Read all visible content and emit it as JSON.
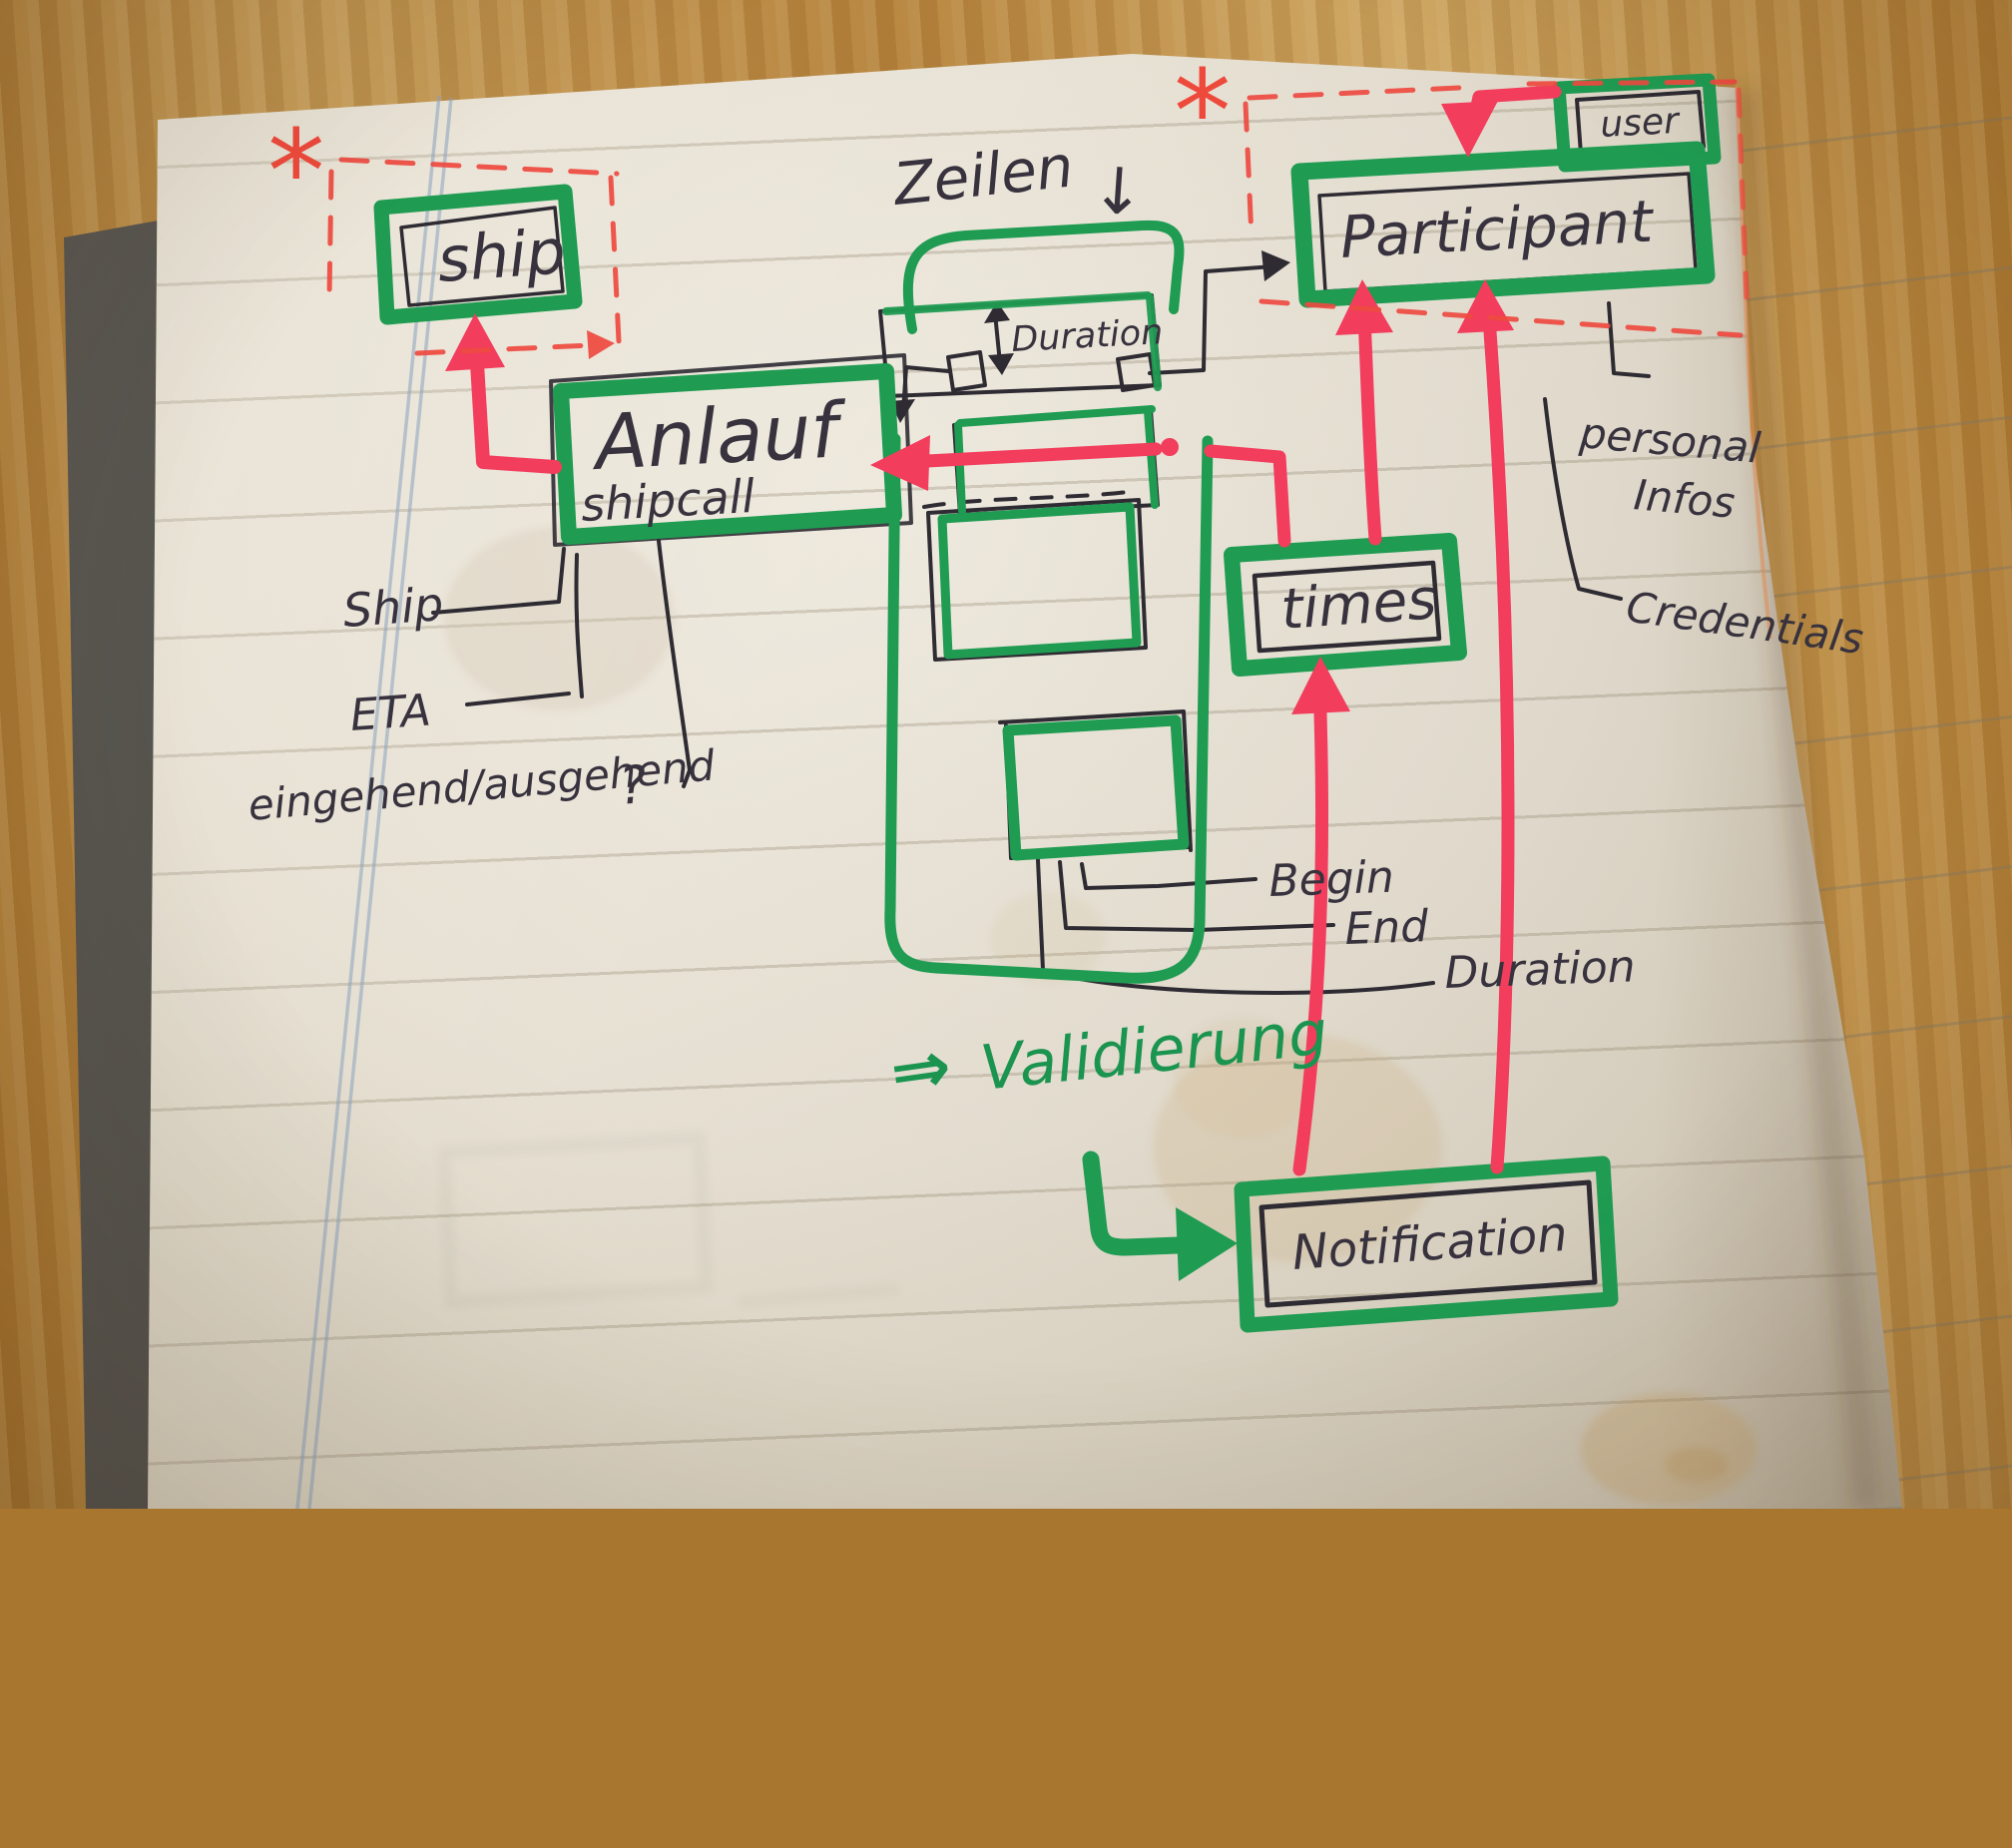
{
  "diagram": {
    "boxes": {
      "ship": {
        "label": "ship"
      },
      "shipcall": {
        "label": "Anlauf",
        "sublabel": "shipcall"
      },
      "duration": {
        "label": "Duration"
      },
      "participant": {
        "label": "Participant"
      },
      "user": {
        "label": "user"
      },
      "times": {
        "label": "times"
      },
      "notification": {
        "label": "Notification"
      }
    },
    "annotations": {
      "zeilen": "Zeilen",
      "zeilen_arrow": "↓",
      "validierung_arrow": "⇒",
      "validierung": "Validierung",
      "asterisk": "*",
      "question_mark": "?"
    },
    "attribute_labels": {
      "ship": "Ship",
      "eta": "ETA",
      "in_out": "eingehend/ausgehend",
      "begin": "Begin",
      "end": "End",
      "duration": "Duration",
      "personal_line1": "personal",
      "personal_line2": "Infos",
      "credentials": "Credentials"
    },
    "colors": {
      "marker_green": "#1f9b52",
      "marker_red": "#f23d5c",
      "dashed_red": "#ee4a40",
      "pen_black": "#2e2b33",
      "paper": "#e7e1d4",
      "wood": "#b5823b"
    }
  }
}
